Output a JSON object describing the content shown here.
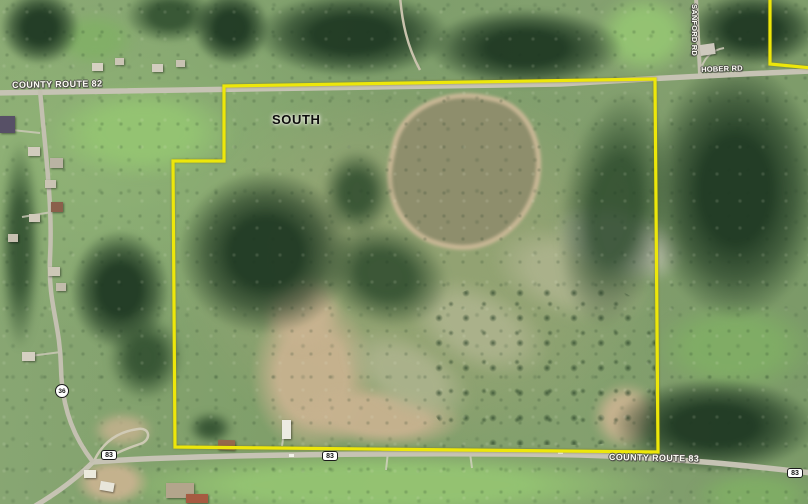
{
  "map": {
    "area_label": "SOUTH",
    "boundary_color": "#ede70a",
    "parcel": {
      "main_boundary_points": "224,86 655,79 658,452 175,447 173,161 224,161",
      "secondary_boundary_points": "770,-4 770,64 812,68"
    },
    "road_labels": [
      {
        "id": "county-route-82",
        "text": "COUNTY ROUTE 82",
        "x": 12,
        "y": 80,
        "rotate": -1,
        "small": false
      },
      {
        "id": "hober-rd",
        "text": "HOBER RD",
        "x": 701,
        "y": 65,
        "rotate": -2,
        "small": true
      },
      {
        "id": "sanford-rd",
        "text": "SANFORD RD",
        "x": 699,
        "y": 4,
        "rotate": 90,
        "small": true
      },
      {
        "id": "county-route-83",
        "text": "COUNTY ROUTE 83",
        "x": 609,
        "y": 452,
        "rotate": 1,
        "small": false
      }
    ],
    "route_shields": [
      {
        "text": "83",
        "x": 101,
        "y": 450,
        "shape": "pill"
      },
      {
        "text": "83",
        "x": 322,
        "y": 451,
        "shape": "pill"
      },
      {
        "text": "83",
        "x": 787,
        "y": 468,
        "shape": "pill"
      },
      {
        "text": "36",
        "x": 55,
        "y": 384,
        "shape": "circle"
      }
    ]
  }
}
